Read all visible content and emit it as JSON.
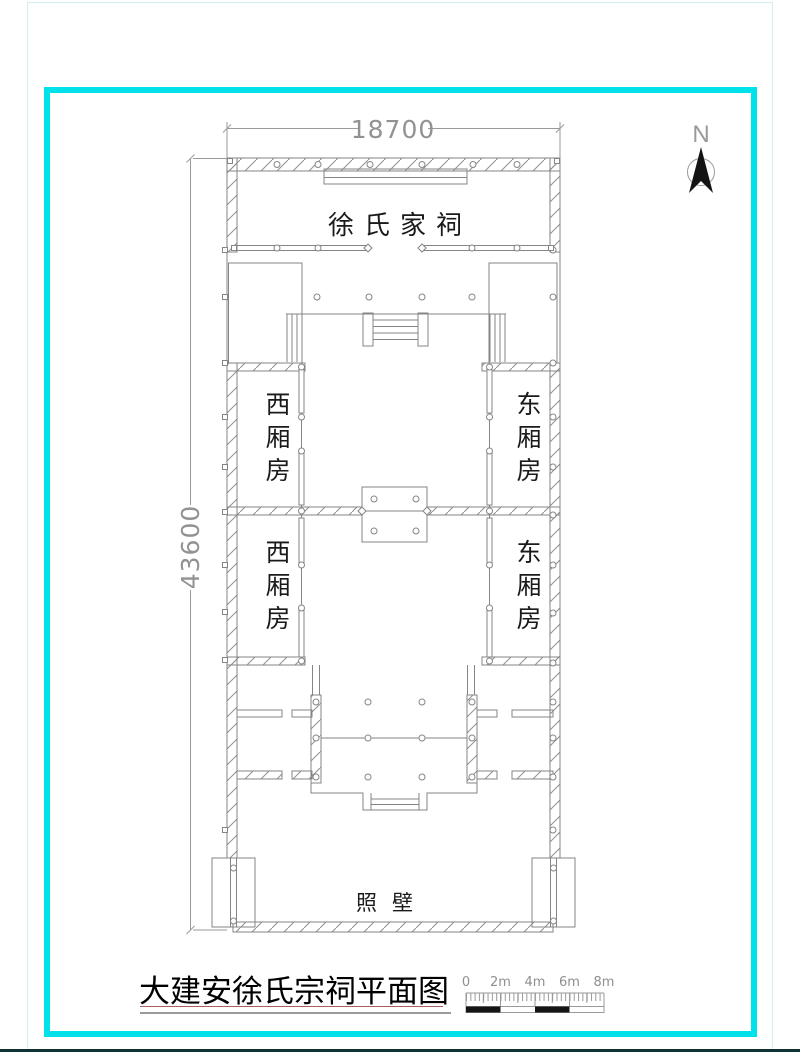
{
  "colors": {
    "frame_cyan": "#00e2ea",
    "frame_pale": "#d2f0f2",
    "footer_edge": "#113232",
    "line_gray": "#858585",
    "ink": "#1a1a1a",
    "underline_red": "#a85f5f",
    "underline_gray": "#9a9a9a"
  },
  "north": {
    "label": "N"
  },
  "dimensions": {
    "top": "18700",
    "left": "43600"
  },
  "rooms": {
    "main_hall": "徐氏家祠",
    "west_wing_upper": "西厢房",
    "west_wing_lower": "西厢房",
    "east_wing_upper": "东厢房",
    "east_wing_lower": "东厢房",
    "screen_wall": "照壁"
  },
  "title": "大建安徐氏宗祠平面图",
  "scale_bar": {
    "labels": [
      "0",
      "2m",
      "4m",
      "6m",
      "8m"
    ]
  }
}
